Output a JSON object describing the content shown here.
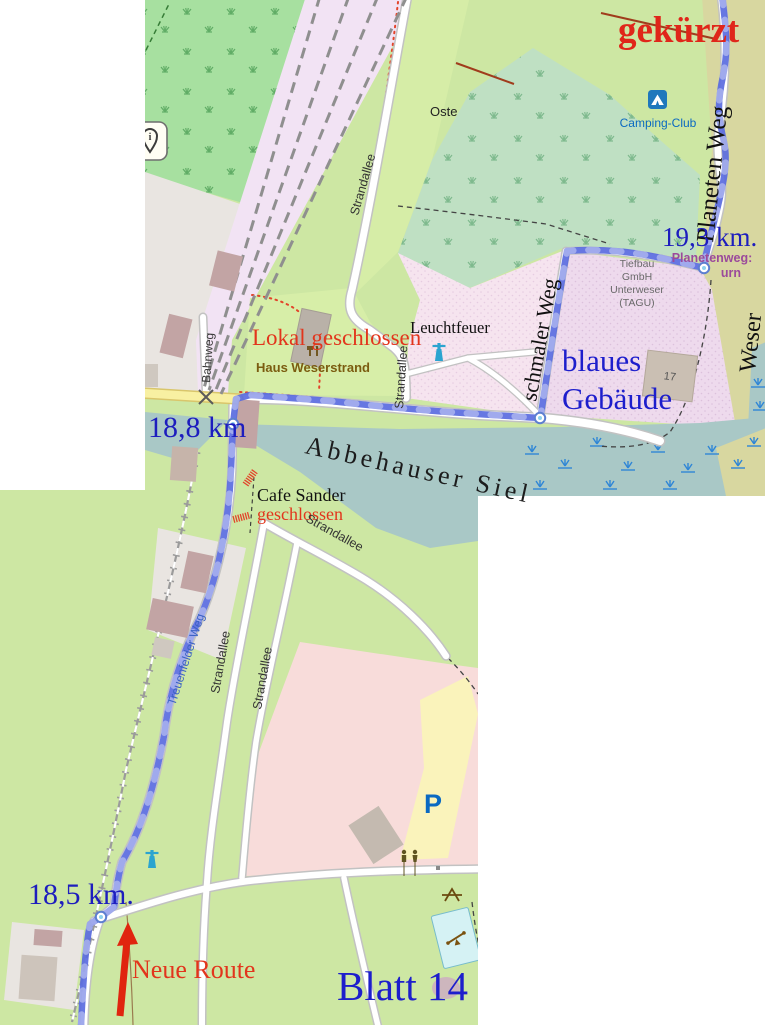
{
  "annotations": {
    "gekuerzt": "gekürzt",
    "km_19_3": "19,3 km.",
    "km_18_8": "18,8 km",
    "km_18_5": "18,5 km.",
    "blaues_gebaeude_line1": "blaues",
    "blaues_gebaeude_line2": "Gebäude",
    "lokal_geschlossen": "Lokal geschlossen",
    "neue_route": "Neue Route",
    "blatt": "Blatt 14"
  },
  "streets": {
    "planeten_weg": "Planeten Weg",
    "schmaler_weg": "schmaler Weg",
    "strandallee": "Strandallee",
    "bahnweg": "Bahnweg",
    "treuenfelder_weg": "Treuenfelder Weg"
  },
  "places": {
    "camping_club": "Camping-Club",
    "oste": "Oste",
    "weser": "Weser",
    "abbehauser_siel": "Abbehauser Siel",
    "leuchtfeuer": "Leuchtfeuer",
    "haus_weserstrand": "Haus Weserstrand",
    "cafe_sander": "Cafe Sander",
    "cafe_status": "geschlossen",
    "planetenweg_sign_line1": "Planetenweg:",
    "planetenweg_sign_line2": "urn",
    "tiefbau_line1": "Tiefbau",
    "tiefbau_line2": "GmbH",
    "tiefbau_line3": "Unterweser",
    "tiefbau_line4": "(TAGU)",
    "building_17": "17",
    "parking_p": "P"
  },
  "colors": {
    "route_blue": "#5a6bdf",
    "annotation_blue": "#1d1ecc",
    "annotation_red": "#e2351c",
    "street_name_blue": "#3b62c4",
    "guidepost_purple": "#9b4a9b",
    "poi_brown": "#7b5c10",
    "camping_blue": "#0a69c2",
    "water": "#a9c8c6",
    "grass": "#cde7a3"
  }
}
